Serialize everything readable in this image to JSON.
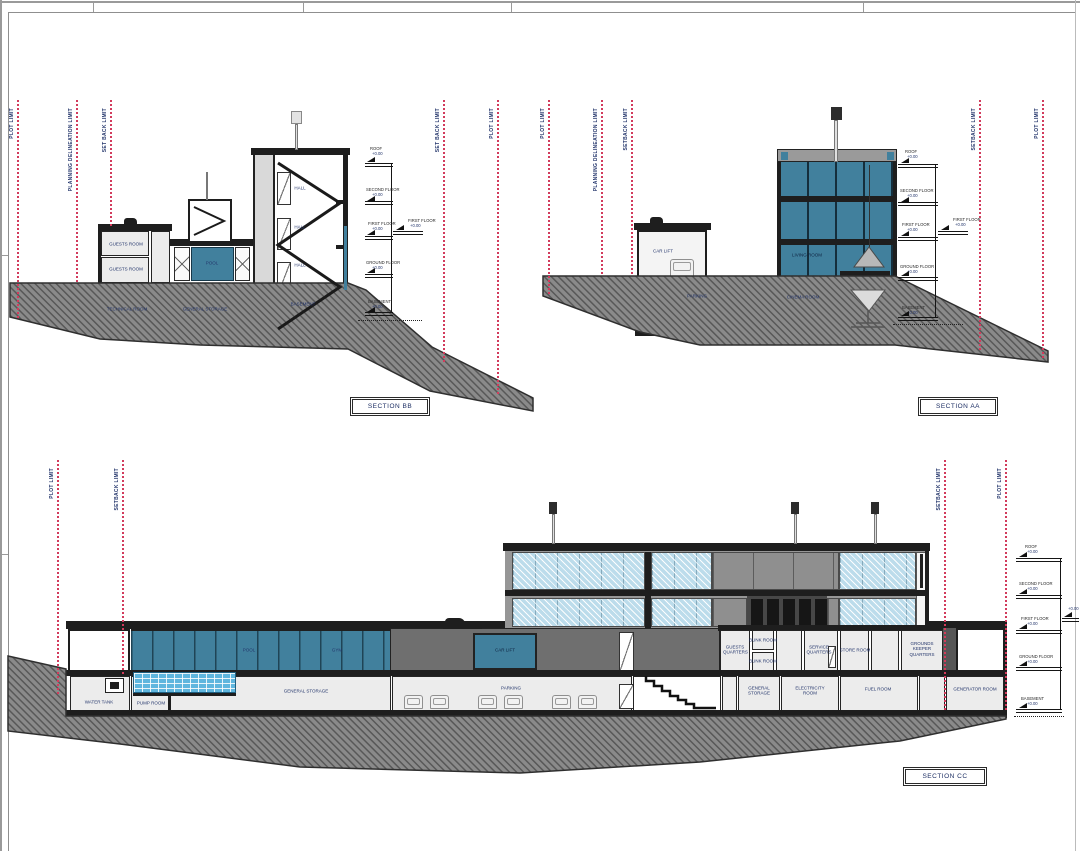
{
  "drawing": {
    "elevation_text": "+0.00",
    "sections": {
      "bb": {
        "label": "SECTION BB",
        "limits_left": [
          "PLOT LIMIT",
          "PLANNING DELINEATION LIMIT",
          "SET BACK LIMIT"
        ],
        "limits_right": [
          "SET BACK LIMIT",
          "PLOT LIMIT"
        ],
        "levels": {
          "roof": "ROOF",
          "second": "SECOND FLOOR",
          "first": "FIRST FLOOR",
          "ground": "GROUND FLOOR",
          "basement": "BASEMENT"
        },
        "rooms": {
          "guests_room_upper": "GUESTS ROOM",
          "guests_room_lower": "GUESTS ROOM",
          "pool": "POOL",
          "technical_room": "TECHNICAL ROOM",
          "general_storage": "GENERAL STORAGE",
          "hall_second": "HALL",
          "hall_first": "HALL",
          "hall_ground": "HALL",
          "basement": "BASEMENT"
        }
      },
      "aa": {
        "label": "SECTION AA",
        "limits_left": [
          "PLOT LIMIT",
          "PLANNING DELINEATION LIMIT",
          "SETBACK LIMIT"
        ],
        "limits_right": [
          "SETBACK LIMIT",
          "PLOT LIMIT"
        ],
        "levels": {
          "roof": "ROOF",
          "second": "SECOND FLOOR",
          "first": "FIRST FLOOR",
          "ground": "GROUND FLOOR",
          "basement": "BASEMENT"
        },
        "rooms": {
          "car_lift": "CAR LIFT",
          "parking": "PARKING",
          "cinema_room": "CINEMA ROOM",
          "living_room": "LIVING ROOM"
        }
      },
      "cc": {
        "label": "SECTION CC",
        "limits_left": [
          "PLOT LIMIT",
          "SETBACK LIMIT"
        ],
        "limits_right": [
          "SETBACK LIMIT",
          "PLOT LIMIT"
        ],
        "levels": {
          "roof": "ROOF",
          "second": "SECOND FLOOR",
          "first": "FIRST FLOOR",
          "ground": "GROUND FLOOR",
          "basement": "BASEMENT"
        },
        "rooms": {
          "pool": "POOL",
          "gym": "GYM",
          "car_lift": "CAR LIFT",
          "guests_quarters": "GUESTS QUARTERS",
          "bunk_room_upper": "BUNK ROOM",
          "bunk_room_lower": "BUNK ROOM",
          "service_quarters": "SERVICE QUARTERS",
          "store_room": "STORE ROOM",
          "grounds_keeper_quarters": "GROUNDS KEEPER QUARTERS",
          "water_tank": "WATER TANK",
          "pump_room": "PUMP ROOM",
          "general_storage_left": "GENERAL STORAGE",
          "parking": "PARKING",
          "general_storage_right": "GENERAL STORAGE",
          "electricity_room": "ELECTRICITY ROOM",
          "fuel_room": "FUEL ROOM",
          "generator_room": "GENERATOR ROOM"
        }
      }
    },
    "colors": {
      "limit_line": "#d23b5c",
      "label_text": "#23356b",
      "teal_glass": "#41809d",
      "glazing_hatch": "#bcdceb",
      "terrain": "#868686",
      "pool_water": "#5fb6de"
    }
  }
}
